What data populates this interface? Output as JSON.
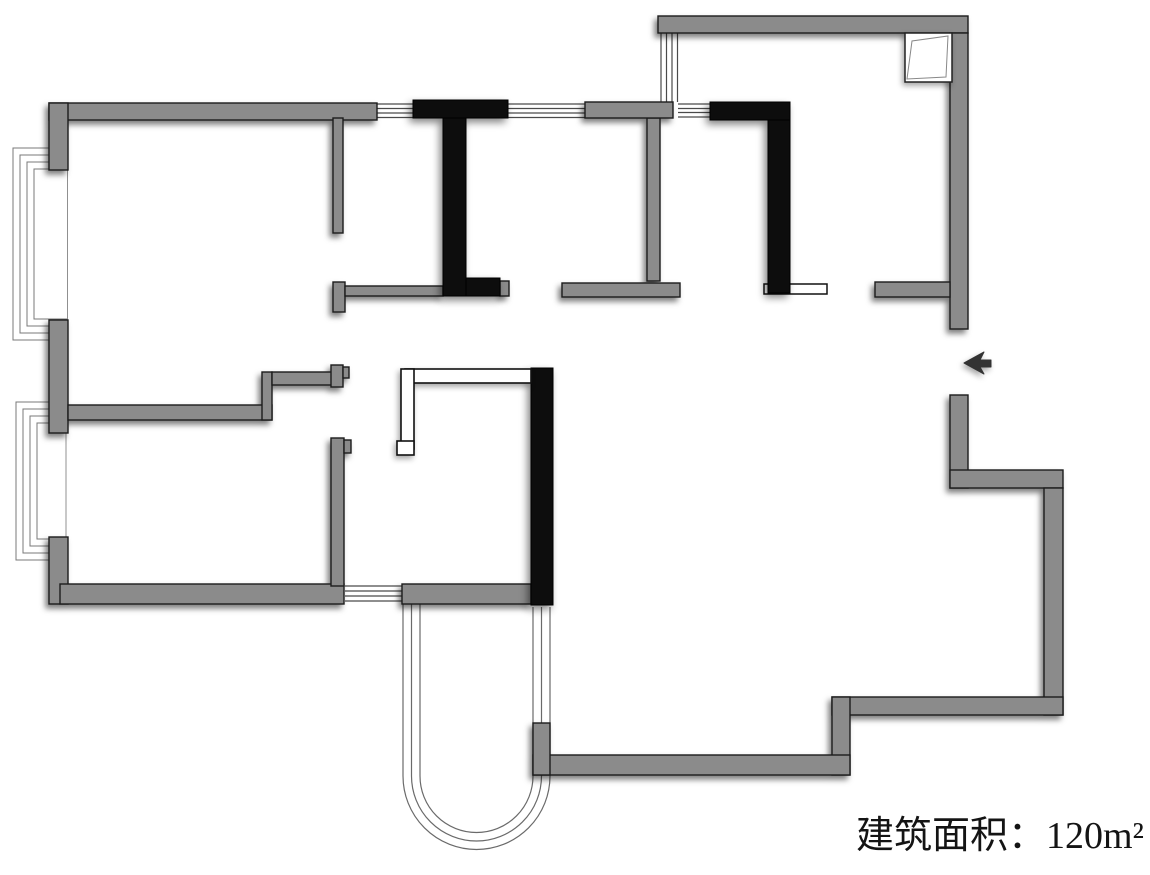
{
  "canvas": {
    "width": 1150,
    "height": 875,
    "background": "#ffffff"
  },
  "palette": {
    "wall_gray": "#8b8b8b",
    "wall_black": "#0d0d0d",
    "wall_outline": "#1c1c1c",
    "window_line": "#4a4a4a",
    "bay_line": "#787878",
    "arc_line": "#6a6a6a",
    "face_line": "#909090",
    "detail_outline": "#111111",
    "arrow_fill": "#333333",
    "white": "#ffffff"
  },
  "label": {
    "text": "建筑面积：120m²"
  },
  "floorplan": {
    "gray_walls": [
      [
        49,
        103,
        328,
        17
      ],
      [
        49,
        103,
        19,
        67
      ],
      [
        49,
        320,
        19,
        113
      ],
      [
        49,
        537,
        19,
        67
      ],
      [
        60,
        584,
        284,
        20
      ],
      [
        68,
        405,
        204,
        15
      ],
      [
        262,
        372,
        10,
        48
      ],
      [
        272,
        372,
        61,
        13
      ],
      [
        331,
        365,
        12,
        22
      ],
      [
        343,
        367,
        6,
        11
      ],
      [
        331,
        438,
        13,
        148
      ],
      [
        344,
        440,
        7,
        13
      ],
      [
        402,
        584,
        129,
        20
      ],
      [
        333,
        118,
        10,
        115
      ],
      [
        333,
        282,
        12,
        30
      ],
      [
        345,
        286,
        98,
        10
      ],
      [
        500,
        281,
        9,
        15
      ],
      [
        562,
        283,
        118,
        14
      ],
      [
        647,
        118,
        13,
        163
      ],
      [
        585,
        102,
        88,
        16
      ],
      [
        658,
        16,
        310,
        17
      ],
      [
        950,
        33,
        18,
        296
      ],
      [
        950,
        395,
        18,
        93
      ],
      [
        875,
        282,
        75,
        15
      ],
      [
        950,
        470,
        113,
        18
      ],
      [
        1044,
        488,
        19,
        227
      ],
      [
        832,
        697,
        231,
        18
      ],
      [
        832,
        697,
        18,
        78
      ],
      [
        533,
        755,
        317,
        20
      ],
      [
        533,
        723,
        17,
        52
      ]
    ],
    "black_walls": [
      [
        413,
        100,
        95,
        18
      ],
      [
        443,
        118,
        23,
        178
      ],
      [
        466,
        278,
        34,
        18
      ],
      [
        710,
        102,
        80,
        18
      ],
      [
        768,
        120,
        22,
        173
      ],
      [
        531,
        368,
        22,
        237
      ]
    ],
    "window_lines": [
      [
        377,
        104,
        413,
        104
      ],
      [
        377,
        108.5,
        413,
        108.5
      ],
      [
        377,
        113,
        413,
        113
      ],
      [
        377,
        117.5,
        413,
        117.5
      ],
      [
        508,
        104,
        585,
        104
      ],
      [
        508,
        108.5,
        585,
        108.5
      ],
      [
        508,
        113,
        585,
        113
      ],
      [
        508,
        117.5,
        585,
        117.5
      ],
      [
        661,
        33,
        661,
        102
      ],
      [
        666.5,
        33,
        666.5,
        102
      ],
      [
        672,
        33,
        672,
        102
      ],
      [
        677.5,
        33,
        677.5,
        102
      ],
      [
        678,
        104,
        710,
        104
      ],
      [
        678,
        108.5,
        710,
        108.5
      ],
      [
        678,
        112.5,
        710,
        112.5
      ],
      [
        678,
        117,
        710,
        117
      ],
      [
        345,
        586,
        402,
        586
      ],
      [
        345,
        591,
        402,
        591
      ],
      [
        345,
        596,
        402,
        596
      ],
      [
        345,
        601,
        402,
        601
      ]
    ],
    "face_lines": [
      [
        67.5,
        170,
        67.5,
        320
      ],
      [
        66,
        433,
        66,
        537
      ]
    ],
    "bay_windows": [
      {
        "x_open": 67,
        "x_out": 13,
        "y_top": 148,
        "y_bottom": 340,
        "count": 4,
        "inset": 7
      },
      {
        "x_open": 67,
        "x_out": 16,
        "y_top": 402,
        "y_bottom": 560,
        "count": 4,
        "inset": 7
      }
    ],
    "arc_window_paths": [
      "M 403 603 L 403 776 A 73.5 73.5 0 0 0 550 776 L 550 607",
      "M 411.5 603 L 411.5 776 A 65 65 0 0 0 541.5 776 L 541.5 607",
      "M 420 603 L 420 776 A 56.5 56.5 0 0 0 533 776 L 533 607"
    ],
    "door_sill": [
      764,
      284,
      63,
      10
    ],
    "partition_rects": [
      [
        405,
        369,
        126,
        14
      ],
      [
        401,
        369,
        13,
        80
      ],
      [
        397,
        441,
        17,
        14
      ]
    ],
    "flue": {
      "box": [
        905,
        33,
        47,
        49
      ],
      "fold": "907,79 912,41 948,36 946,77"
    },
    "entry_arrow": "964,363 984,352 980,360 991,360 991,367 980,367 984,374"
  }
}
